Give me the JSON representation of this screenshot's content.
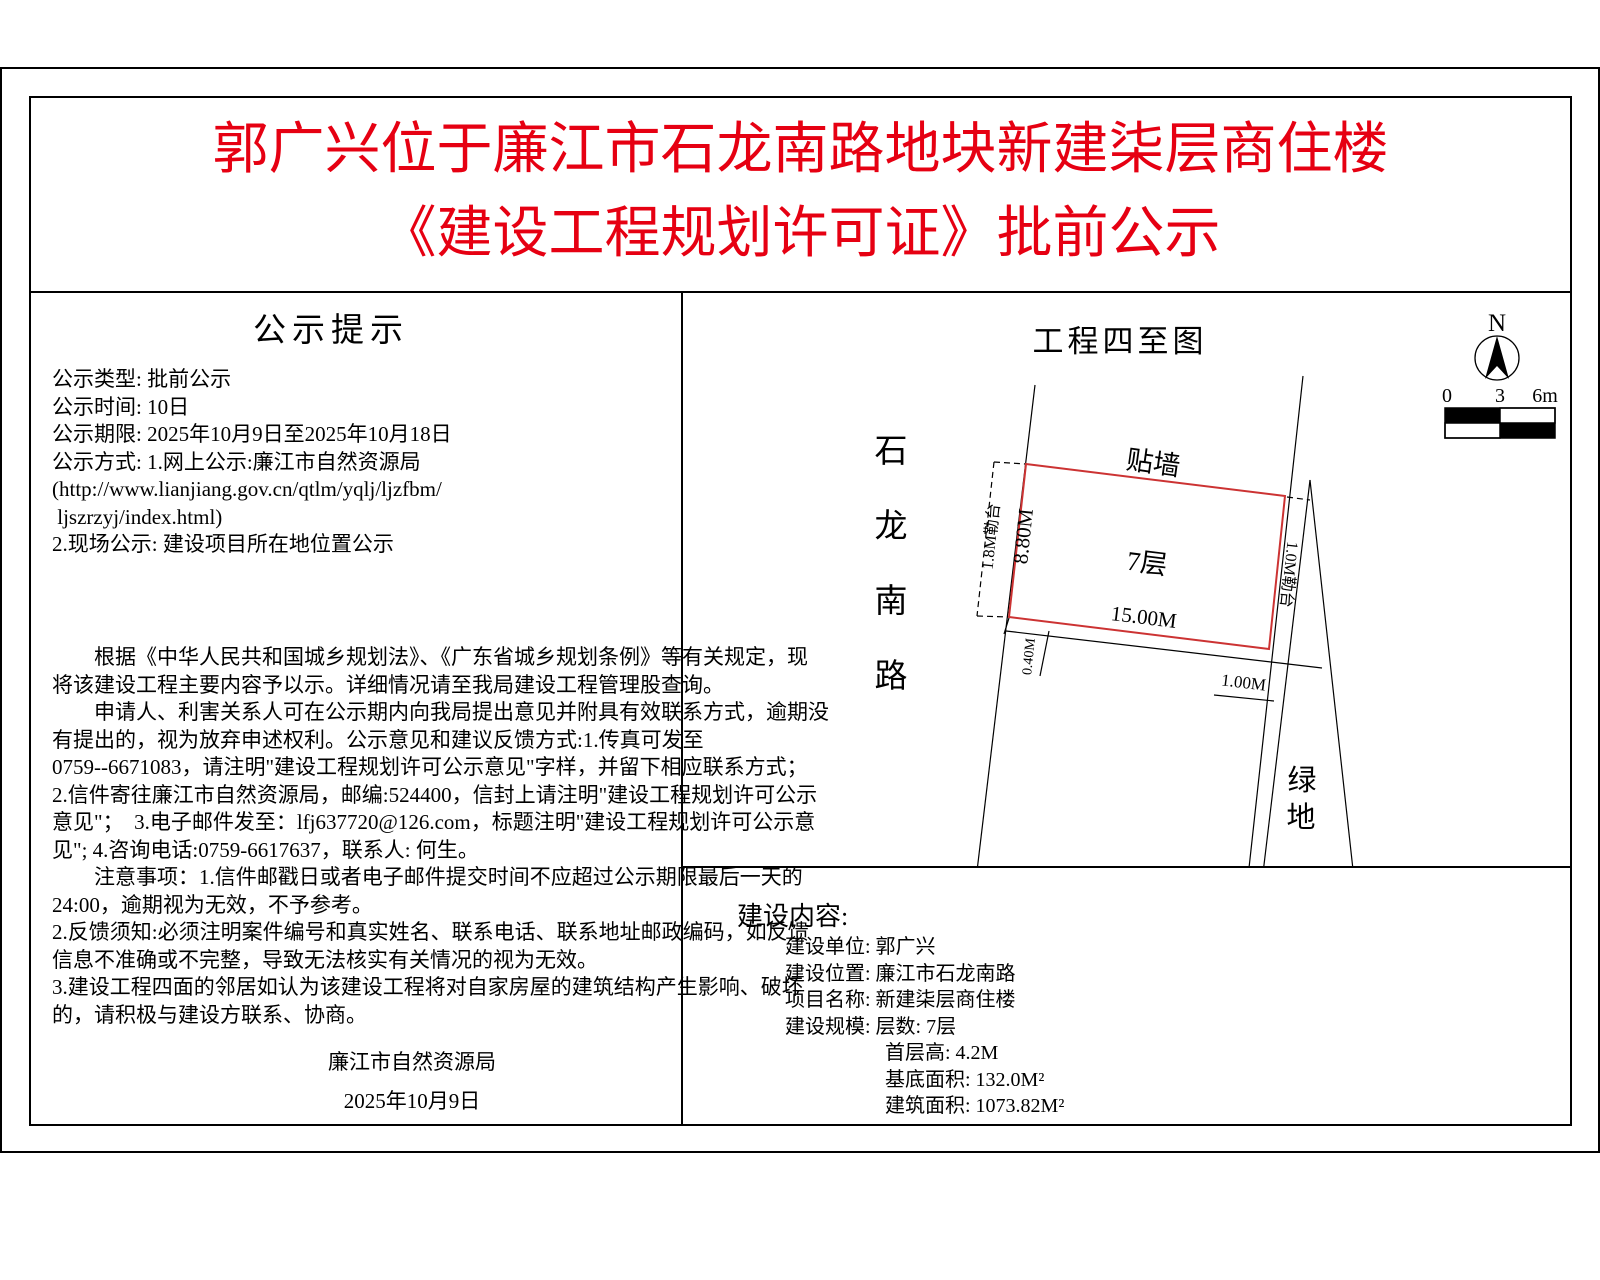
{
  "title": {
    "line1": "郭广兴位于廉江市石龙南路地块新建柒层商住楼",
    "line2": "《建设工程规划许可证》批前公示"
  },
  "colors": {
    "title_red": "#e60012",
    "parcel_red": "#cc3333",
    "line_black": "#000000"
  },
  "notice": {
    "title": "公示提示",
    "info_lines": [
      "公示类型: 批前公示",
      "公示时间: 10日",
      "公示期限: 2025年10月9日至2025年10月18日",
      "公示方式: 1.网上公示:廉江市自然资源局",
      "(http://www.lianjiang.gov.cn/qtlm/yqlj/ljzfbm/",
      " ljszrzyj/index.html)",
      "2.现场公示: 建设项目所在地位置公示"
    ],
    "body_lines": [
      "　　根据《中华人民共和国城乡规划法》、《广东省城乡规划条例》等有关规定，现",
      "将该建设工程主要内容予以示。详细情况请至我局建设工程管理股查询。",
      "　　申请人、利害关系人可在公示期内向我局提出意见并附具有效联系方式，逾期没",
      "有提出的，视为放弃申述权利。公示意见和建议反馈方式:1.传真可发至",
      "0759--6671083，请注明\"建设工程规划许可公示意见\"字样，并留下相应联系方式；",
      "2.信件寄往廉江市自然资源局，邮编:524400，信封上请注明\"建设工程规划许可公示",
      "意见\"；  3.电子邮件发至：lfj637720@126.com，标题注明\"建设工程规划许可公示意",
      "见\"; 4.咨询电话:0759-6617637，联系人: 何生。",
      "　　注意事项：1.信件邮戳日或者电子邮件提交时间不应超过公示期限最后一天的",
      "24:00，逾期视为无效，不予参考。",
      "2.反馈须知:必须注明案件编号和真实姓名、联系电话、联系地址邮政编码，如反馈",
      "信息不准确或不完整，导致无法核实有关情况的视为无效。",
      "3.建设工程四面的邻居如认为该建设工程将对自家房屋的建筑结构产生影响、破坏",
      "的，请积极与建设方联系、协商。"
    ],
    "signature": "廉江市自然资源局",
    "date": "2025年10月9日"
  },
  "map": {
    "title": "工程四至图",
    "compass_n": "N",
    "scale_labels": [
      "0",
      "3",
      "6m"
    ],
    "road_name_chars": [
      "石",
      "龙",
      "南",
      "路"
    ],
    "green_chars": [
      "绿",
      "地"
    ],
    "labels": {
      "wall_attach": "贴墙",
      "floors": "7层",
      "dim_south": "15.00M",
      "dim_west": "8.80M",
      "strip_west": "1.8M勒台",
      "strip_east": "1.0M勒台",
      "dim_offset": "0.40M",
      "dim_gap": "1.00M"
    }
  },
  "content": {
    "title": "建设内容:",
    "items": [
      "建设单位: 郭广兴",
      "建设位置: 廉江市石龙南路",
      "项目名称: 新建柒层商住楼",
      "建设规模: 层数: 7层",
      "首层高: 4.2M",
      "基底面积: 132.0M²",
      "建筑面积: 1073.82M²"
    ]
  }
}
